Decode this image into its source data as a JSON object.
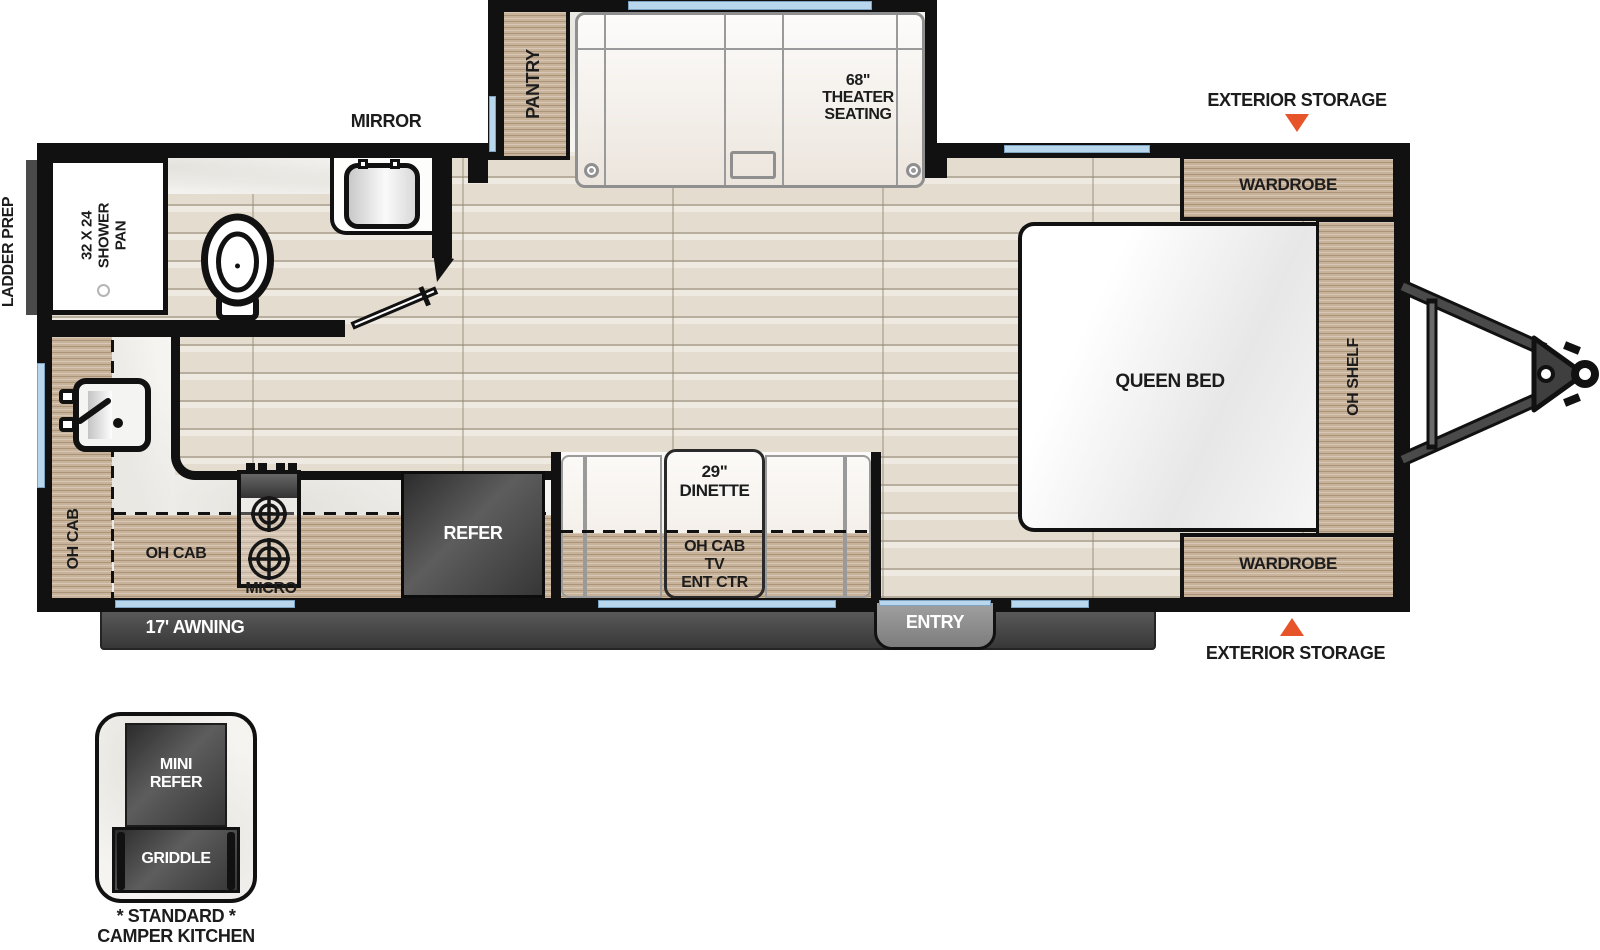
{
  "colors": {
    "accent_orange": "#E8542A",
    "wall_black": "#111111",
    "wood_cabinet": "#C8B29A",
    "floor_plank": "#E4DDCF",
    "window_blue": "#B9D7EC",
    "awning_gray": "#4A4A4A",
    "appliance_dark": "#3D3D3D"
  },
  "exterior": {
    "ladder_prep": "LADDER PREP",
    "storage_top": "EXTERIOR STORAGE",
    "storage_bottom": "EXTERIOR STORAGE",
    "awning": "17' AWNING",
    "entry": "ENTRY"
  },
  "slideout": {
    "pantry": "PANTRY",
    "theater_seating": "68\"\nTHEATER\nSEATING"
  },
  "bathroom": {
    "mirror": "MIRROR",
    "shower_pan": "32 X 24\nSHOWER\nPAN"
  },
  "bedroom": {
    "wardrobe_top": "WARDROBE",
    "wardrobe_bottom": "WARDROBE",
    "oh_shelf": "OH SHELF",
    "queen_bed": "QUEEN BED"
  },
  "kitchen": {
    "oh_cab_left": "OH CAB",
    "oh_cab_bottom": "OH CAB",
    "micro": "MICRO",
    "refer": "REFER"
  },
  "dinette": {
    "size_label": "29\"\nDINETTE",
    "oh_cab_tv": "OH CAB\nTV\nENT CTR"
  },
  "camper_kitchen": {
    "mini_refer": "MINI\nREFER",
    "griddle": "GRIDDLE",
    "caption_top": "* STANDARD *",
    "caption_bottom": "CAMPER KITCHEN"
  }
}
